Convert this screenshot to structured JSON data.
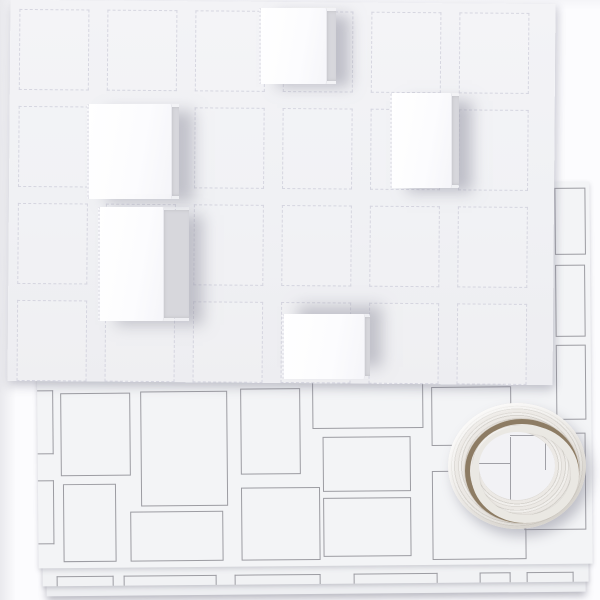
{
  "scene": {
    "description": "Product photo of a white advent calendar craft kit: perforated front panel with five opened 3D paper doors, a stack of backing sheets printed with gray rectangle outlines, and a roll of translucent double-sided adhesive tape",
    "background_color": "#fcfcfe",
    "width": 600,
    "height": 600
  },
  "front_panel": {
    "left": 9,
    "top": 2,
    "width": 545,
    "height": 381,
    "rotation_deg": 0.45,
    "color": "#f1f1f4",
    "door_grid": {
      "cols": 6,
      "rows": 4,
      "origin_x": 9,
      "origin_y": 9,
      "pitch_x": 88,
      "pitch_y": 97,
      "door_w": 68,
      "door_h": 79,
      "outline_color": "rgba(202,202,215,0.7)"
    }
  },
  "open_boxes": [
    {
      "left": 259,
      "top": 8,
      "w": 77,
      "h": 76,
      "front_w": 66,
      "shadow": "16px 5px 14px -2px rgba(148,148,162,0.55)"
    },
    {
      "left": 390,
      "top": 93,
      "w": 69,
      "h": 95,
      "front_w": 60,
      "shadow": "15px 6px 14px -2px rgba(148,148,162,0.55)"
    },
    {
      "left": 87,
      "top": 104,
      "w": 92,
      "h": 95,
      "front_w": 83,
      "shadow": "17px 5px 14px -2px rgba(148,148,162,0.5)"
    },
    {
      "left": 98,
      "top": 207,
      "w": 91,
      "h": 114,
      "front_w": 64,
      "shadow": "16px 6px 14px -2px rgba(148,148,162,0.5)"
    },
    {
      "left": 282,
      "top": 314,
      "w": 88,
      "h": 65,
      "front_w": 81,
      "shadow": "14px -10px 14px -2px rgba(148,148,162,0.5)"
    }
  ],
  "printed_sheets": {
    "outline_color": "#9c9ca2",
    "layers": [
      {
        "id": "sheet1",
        "left": 37,
        "top": 184,
        "width": 554,
        "height": 382,
        "color": "#f3f4f6"
      },
      {
        "id": "sheet2",
        "left": 41,
        "top": 200,
        "width": 546,
        "height": 384,
        "color": "#f1f2f4"
      },
      {
        "id": "sheet3",
        "left": 45,
        "top": 212,
        "width": 539,
        "height": 382,
        "color": "#edeef1"
      }
    ],
    "rects": [
      {
        "x": 23,
        "y": 207,
        "w": 68,
        "h": 81
      },
      {
        "x": 103,
        "y": 206,
        "w": 85,
        "h": 113
      },
      {
        "x": 203,
        "y": 204,
        "w": 58,
        "h": 84
      },
      {
        "x": 25,
        "y": 298,
        "w": 51,
        "h": 76
      },
      {
        "x": 92,
        "y": 326,
        "w": 91,
        "h": 48
      },
      {
        "x": 203,
        "y": 303,
        "w": 77,
        "h": 71
      },
      {
        "x": 275,
        "y": 168,
        "w": 109,
        "h": 75
      },
      {
        "x": 285,
        "y": 253,
        "w": 86,
        "h": 53
      },
      {
        "x": 285,
        "y": 314,
        "w": 86,
        "h": 57
      },
      {
        "x": 394,
        "y": 204,
        "w": 78,
        "h": 57
      },
      {
        "x": 394,
        "y": 288,
        "w": 92,
        "h": 87
      },
      {
        "x": 486,
        "y": 251,
        "w": 60,
        "h": 95
      },
      {
        "x": 519,
        "y": 6,
        "w": 29,
        "h": 65
      },
      {
        "x": 519,
        "y": 83,
        "w": 28,
        "h": 70
      },
      {
        "x": 519,
        "y": 163,
        "w": 28,
        "h": 73
      }
    ],
    "left_margin_partials": [
      {
        "x": 0,
        "y": 204,
        "w": 15,
        "h": 62
      },
      {
        "x": 0,
        "y": 294,
        "w": 15,
        "h": 62
      }
    ],
    "peek_segments": [
      {
        "x": 14,
        "w": 55
      },
      {
        "x": 81,
        "w": 91
      },
      {
        "x": 192,
        "w": 84
      },
      {
        "x": 311,
        "w": 82
      },
      {
        "x": 437,
        "w": 29
      },
      {
        "x": 484,
        "w": 45
      }
    ],
    "peek_y": 374,
    "peek_h": 9
  },
  "tape_roll": {
    "left": 448,
    "top": 403,
    "outer_w": 138,
    "outer_h": 126,
    "band_color": "#ebe9e6",
    "core_ring_color": "#8d7c64",
    "inner_band_color": "#eae8e3",
    "hole_color": "#f2f2f5",
    "core_ring": {
      "left": 17,
      "top": 16,
      "w": 104,
      "h": 94
    },
    "inner_band": {
      "left": 23,
      "top": 22,
      "w": 92,
      "h": 82
    },
    "hole": {
      "left": 31,
      "top": 29,
      "w": 76,
      "h": 68
    },
    "hole_lines": [
      {
        "x": 31,
        "y": 5,
        "w": 1,
        "h": 63
      },
      {
        "x": 0,
        "y": 31,
        "w": 31,
        "h": 1
      },
      {
        "x": 31,
        "y": 3,
        "w": 35,
        "h": 1
      },
      {
        "x": 66,
        "y": 3,
        "w": 1,
        "h": 35
      }
    ]
  }
}
